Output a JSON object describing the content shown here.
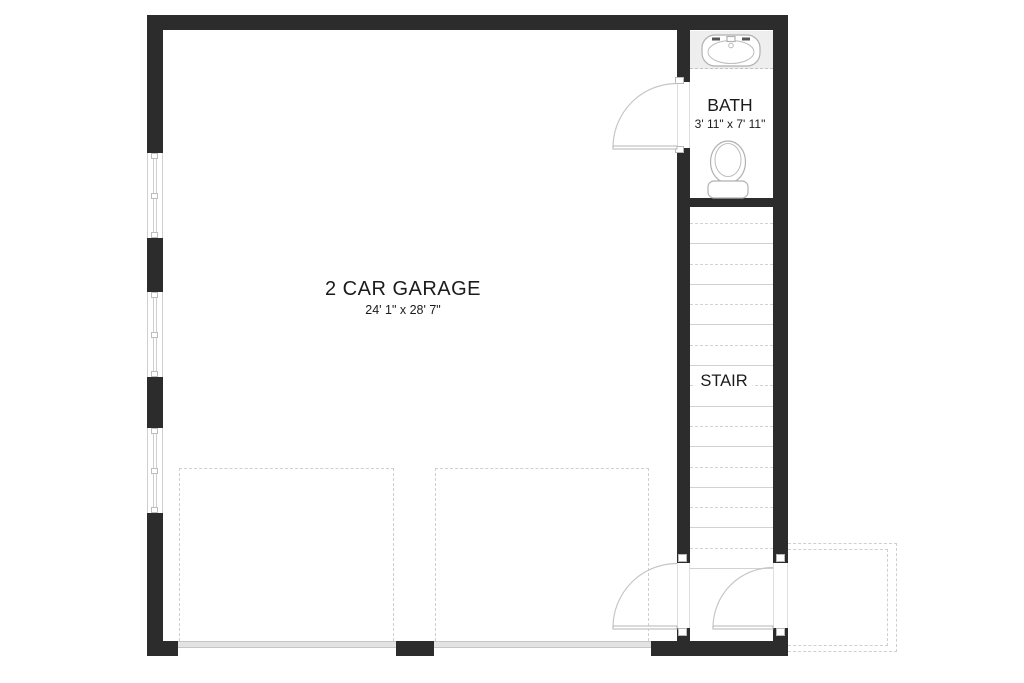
{
  "rooms": {
    "garage": {
      "name": "2 CAR GARAGE",
      "size": "24' 1\" x 28' 7\""
    },
    "bath": {
      "name": "BATH",
      "size": "3' 11\" x 7' 11\""
    },
    "stair": {
      "name": "STAIR"
    }
  },
  "features": {
    "left_wall_windows": 3,
    "garage_door_bays": 2,
    "swing_doors": 3,
    "stair_tread_lines": 18
  },
  "colors": {
    "wall": "#2c2c2c",
    "line": "#d2d2d2",
    "dash": "#cfcfcf",
    "frame": "#cfcfcf",
    "panel": "#e3e3e3",
    "counter": "#eeeeee",
    "text": "#1b1b1b"
  }
}
